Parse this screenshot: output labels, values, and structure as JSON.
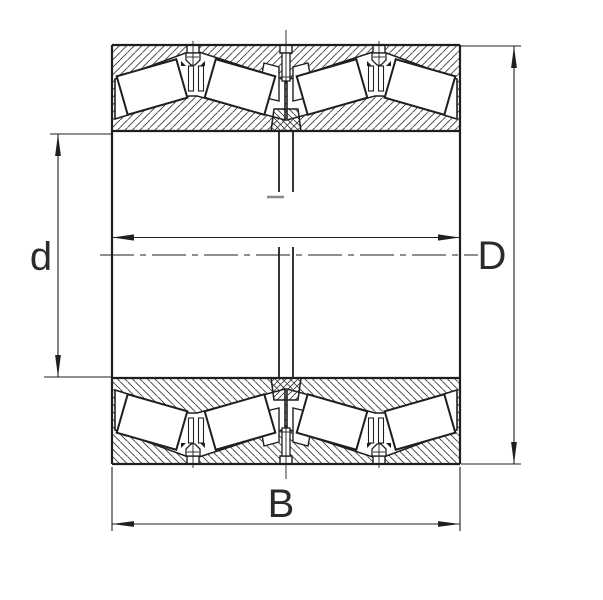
{
  "drawing": {
    "type": "technical-section",
    "subject": "four-row tapered roller bearing cross-section",
    "labels": {
      "bore_diameter": "d",
      "outer_diameter": "D",
      "width": "B"
    },
    "colors": {
      "line": "#1f1f1f",
      "hatch": "#3a3a3a",
      "background": "#ffffff",
      "break_mark": "#8a8a8a"
    }
  }
}
